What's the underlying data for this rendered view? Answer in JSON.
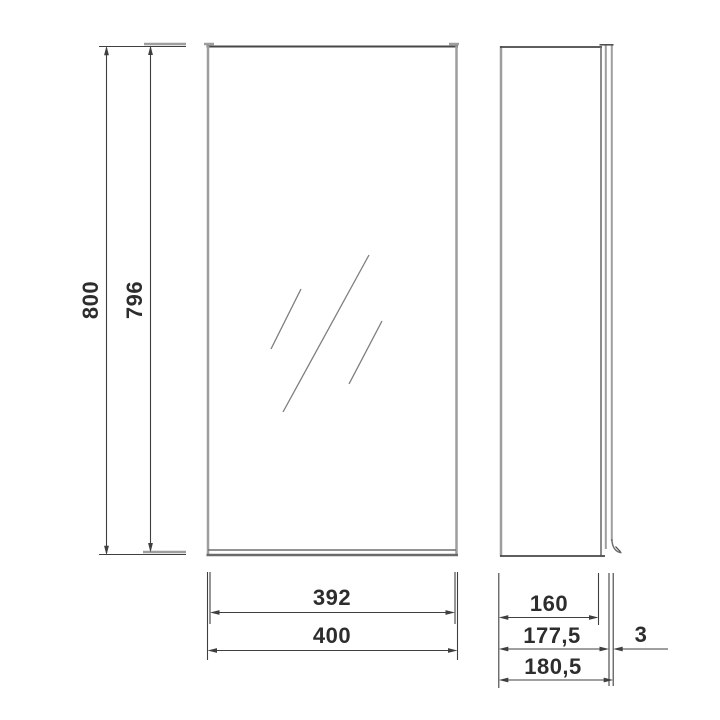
{
  "dimensions": {
    "height_total": "800",
    "height_inner": "796",
    "width_mirror": "392",
    "width_total": "400",
    "depth_body": "160",
    "depth_with_door": "177,5",
    "mirror_glass_thickness": "3",
    "depth_total": "180,5"
  },
  "colors": {
    "background": "#ffffff",
    "edge_gray": "#9e9e9e",
    "edge_dark": "#474747",
    "dimension_line": "#3f3f3f",
    "text": "#2d2d2d",
    "mirror_hatch": "#7e7e7e"
  }
}
